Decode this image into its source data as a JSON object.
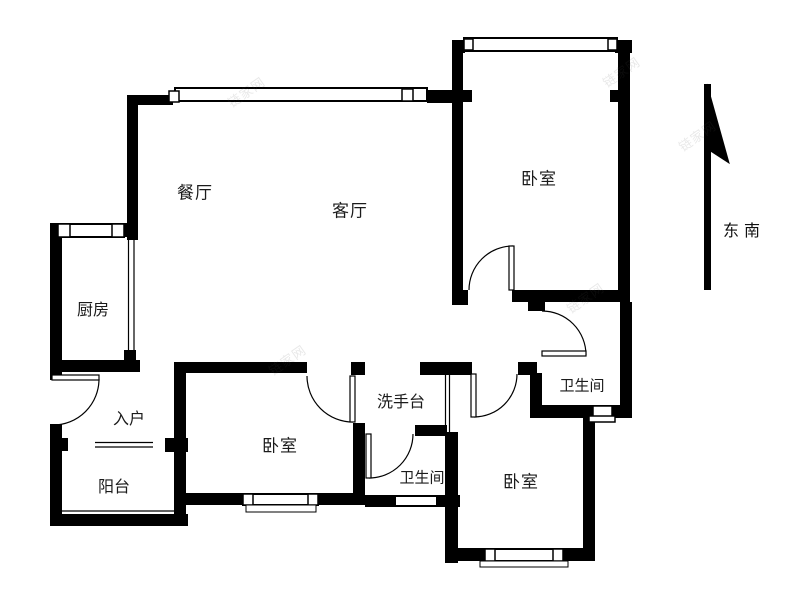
{
  "floorplan": {
    "rooms": [
      {
        "id": "dining",
        "label": "餐厅"
      },
      {
        "id": "living",
        "label": "客厅"
      },
      {
        "id": "bedroom-top-right",
        "label": "卧室"
      },
      {
        "id": "kitchen",
        "label": "厨房"
      },
      {
        "id": "entry",
        "label": "入户"
      },
      {
        "id": "balcony",
        "label": "阳台"
      },
      {
        "id": "bedroom-bottom-center",
        "label": "卧室"
      },
      {
        "id": "washstand",
        "label": "洗手台"
      },
      {
        "id": "bathroom-right",
        "label": "卫生间"
      },
      {
        "id": "bathroom-bottom",
        "label": "卫生间"
      },
      {
        "id": "bedroom-bottom-right",
        "label": "卧室"
      }
    ],
    "compass": {
      "direction_label": "东南"
    },
    "watermark_text": "链家网",
    "colors": {
      "wall": "#000000",
      "background": "#ffffff",
      "label": "#1b1b1b"
    }
  }
}
